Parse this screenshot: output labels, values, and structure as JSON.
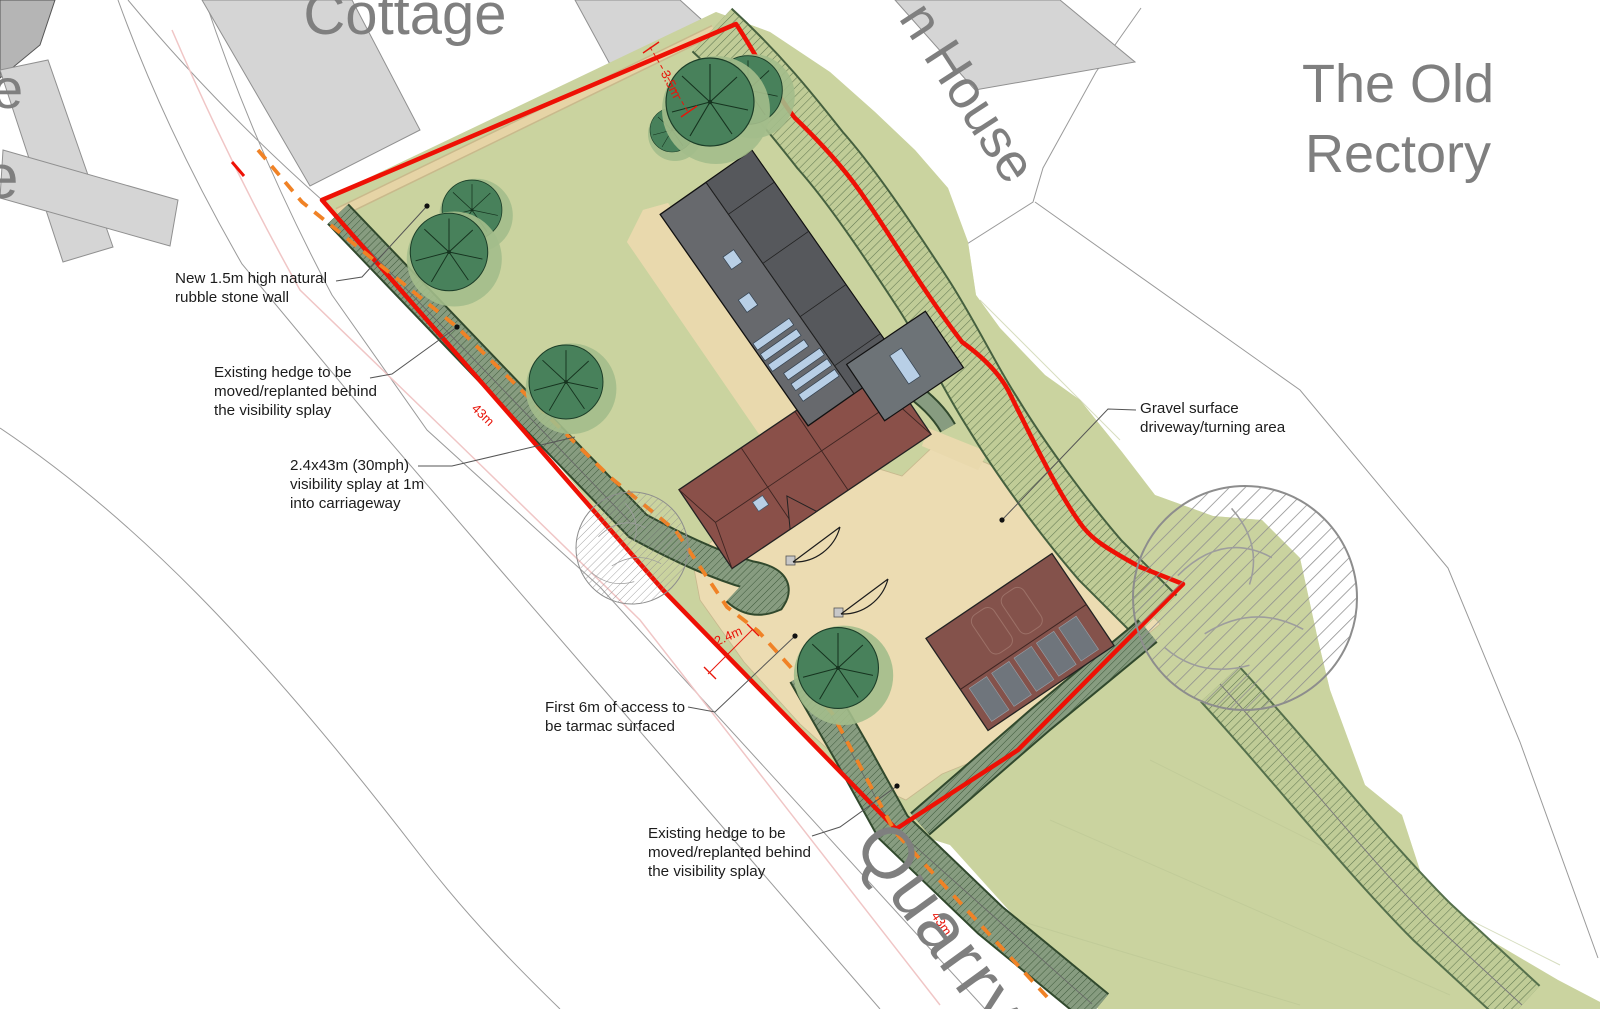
{
  "place_labels": {
    "cottage": "Cottage",
    "house_partial": "n House",
    "old_rectory": {
      "line1": "The Old",
      "line2": "Rectory"
    },
    "road_name": "Quarry",
    "edge_partial_top": "e",
    "edge_partial_bottom": "e"
  },
  "annotations": {
    "stone_wall": {
      "lines": [
        "New 1.5m high natural",
        "rubble stone wall"
      ]
    },
    "hedge_upper": {
      "lines": [
        "Existing hedge to be",
        "moved/replanted behind",
        "the visibility splay"
      ]
    },
    "visibility_splay": {
      "lines": [
        "2.4x43m (30mph)",
        "visibility splay at 1m",
        "into carriageway"
      ]
    },
    "tarmac_access": {
      "lines": [
        "First 6m of access to",
        "be  tarmac surfaced"
      ]
    },
    "hedge_lower": {
      "lines": [
        "Existing hedge to be",
        "moved/replanted behind",
        "the visibility splay"
      ]
    },
    "gravel_driveway": {
      "lines": [
        "Gravel surface",
        "driveway/turning area"
      ]
    }
  },
  "dimensions": {
    "gap_top": "3.5m",
    "splay_length_upper": "43m",
    "gate_width": "2.4m",
    "splay_length_lower": "43m"
  },
  "colors": {
    "site_green": "#cad39f",
    "hedge_dark": "#879c80",
    "hedge_light": "#c0cc97",
    "driveway_tan": "#ecdcb2",
    "stone_paving": "#e9d9ad",
    "barn_gray_dark": "#56585c",
    "barn_gray_light": "#67696d",
    "house_red": "#8a5049",
    "garage_red": "#84524b",
    "solar_panel_gray": "#6f757c",
    "annexe_gray": "#6d7377",
    "skylight_blue": "#b8cfe6",
    "neighbor_gray": "#d5d5d5",
    "boundary_red": "#ee1105",
    "splay_orange": "#f08226",
    "road_centerline_pink": "#f0c6c6",
    "place_label_gray": "#7f7f7f",
    "annotation_black": "#1c1c1c"
  }
}
